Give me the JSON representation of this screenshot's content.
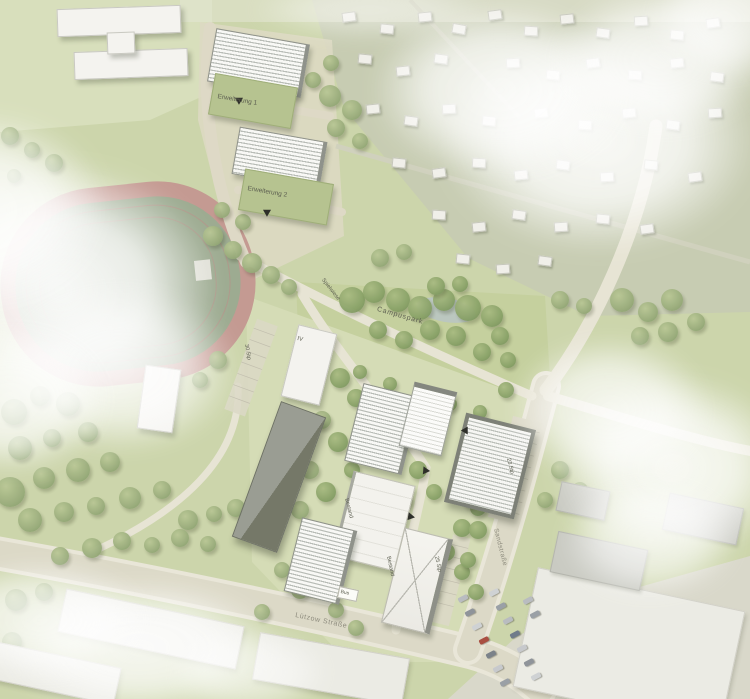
{
  "labels": {
    "erweiterung_1": "Erweiterung 1",
    "erweiterung_2": "Erweiterung 2",
    "campuspark": "Campuspark",
    "spielwiese": "Spielwiese",
    "street_bottom": "Lützow Straße",
    "street_right": "Sandstraße",
    "bus_stop": "Bus",
    "bestand_a": "Bestand",
    "bestand_b": "Bestand",
    "storeys_iv": "IV",
    "parking_a": "23 Stp",
    "parking_b": "25 Stp",
    "parking_c": "30 Stp"
  },
  "colors": {
    "base_green": "#ccd5ab",
    "lawn": "#d8dfbc",
    "allotment": "#c7ccb2",
    "park": "#c5d09e",
    "campus_ground": "#d5dcb6",
    "road": "#dcd9c7",
    "track_ring": "#c49a92",
    "track_infield": "#9dab91",
    "building_white": "#f4f3ef",
    "building_green": "#b6c390",
    "pond": "#b9c6c4",
    "industrial": "#d9d8ca"
  },
  "map_data": {
    "trees": [
      [
        14,
        412,
        13,
        0
      ],
      [
        40,
        396,
        10,
        0
      ],
      [
        68,
        404,
        12,
        0
      ],
      [
        20,
        448,
        12,
        0
      ],
      [
        52,
        438,
        9,
        0
      ],
      [
        88,
        432,
        10,
        0
      ],
      [
        10,
        492,
        15,
        0
      ],
      [
        44,
        478,
        11,
        0
      ],
      [
        78,
        470,
        12,
        0
      ],
      [
        110,
        462,
        10,
        0
      ],
      [
        30,
        520,
        12,
        0
      ],
      [
        64,
        512,
        10,
        0
      ],
      [
        96,
        506,
        9,
        0
      ],
      [
        130,
        498,
        11,
        0
      ],
      [
        162,
        490,
        9,
        0
      ],
      [
        188,
        520,
        10,
        0
      ],
      [
        214,
        514,
        8,
        0
      ],
      [
        236,
        508,
        9,
        0
      ],
      [
        60,
        556,
        9,
        0
      ],
      [
        92,
        548,
        10,
        0
      ],
      [
        122,
        541,
        9,
        0
      ],
      [
        152,
        545,
        8,
        0
      ],
      [
        180,
        538,
        9,
        0
      ],
      [
        208,
        544,
        8,
        0
      ],
      [
        16,
        600,
        11,
        0
      ],
      [
        44,
        592,
        9,
        0
      ],
      [
        12,
        642,
        10,
        0
      ],
      [
        262,
        612,
        8,
        0
      ],
      [
        10,
        136,
        9,
        0
      ],
      [
        32,
        150,
        8,
        0
      ],
      [
        54,
        163,
        9,
        0
      ],
      [
        14,
        176,
        7,
        0
      ],
      [
        213,
        236,
        10,
        0
      ],
      [
        233,
        250,
        9,
        0
      ],
      [
        252,
        263,
        10,
        0
      ],
      [
        271,
        275,
        9,
        0
      ],
      [
        289,
        287,
        8,
        0
      ],
      [
        243,
        222,
        8,
        0
      ],
      [
        222,
        210,
        8,
        0
      ],
      [
        330,
        96,
        11,
        0
      ],
      [
        352,
        110,
        10,
        0
      ],
      [
        336,
        128,
        9,
        0
      ],
      [
        360,
        141,
        8,
        0
      ],
      [
        331,
        63,
        8,
        0
      ],
      [
        313,
        80,
        8,
        0
      ],
      [
        352,
        300,
        13,
        1
      ],
      [
        374,
        292,
        11,
        1
      ],
      [
        398,
        300,
        12,
        1
      ],
      [
        420,
        308,
        12,
        1
      ],
      [
        444,
        300,
        11,
        1
      ],
      [
        468,
        308,
        13,
        1
      ],
      [
        492,
        316,
        11,
        1
      ],
      [
        430,
        330,
        10,
        1
      ],
      [
        456,
        336,
        10,
        1
      ],
      [
        404,
        340,
        9,
        1
      ],
      [
        378,
        330,
        9,
        1
      ],
      [
        500,
        336,
        9,
        1
      ],
      [
        482,
        352,
        9,
        1
      ],
      [
        508,
        360,
        8,
        1
      ],
      [
        436,
        286,
        9,
        1
      ],
      [
        460,
        284,
        8,
        1
      ],
      [
        360,
        372,
        7,
        1
      ],
      [
        390,
        384,
        7,
        1
      ],
      [
        420,
        396,
        7,
        1
      ],
      [
        450,
        404,
        7,
        1
      ],
      [
        480,
        412,
        7,
        1
      ],
      [
        506,
        390,
        8,
        1
      ],
      [
        340,
        378,
        10,
        1
      ],
      [
        356,
        398,
        9,
        1
      ],
      [
        322,
        420,
        9,
        0
      ],
      [
        338,
        442,
        10,
        1
      ],
      [
        310,
        470,
        9,
        0
      ],
      [
        326,
        492,
        10,
        1
      ],
      [
        300,
        510,
        9,
        0
      ],
      [
        352,
        470,
        8,
        1
      ],
      [
        368,
        448,
        8,
        1
      ],
      [
        418,
        470,
        9,
        1
      ],
      [
        434,
        492,
        8,
        1
      ],
      [
        404,
        500,
        8,
        1
      ],
      [
        462,
        528,
        9,
        1
      ],
      [
        478,
        508,
        8,
        1
      ],
      [
        446,
        552,
        9,
        1
      ],
      [
        462,
        572,
        8,
        1
      ],
      [
        430,
        592,
        8,
        1
      ],
      [
        300,
        590,
        9,
        0
      ],
      [
        282,
        570,
        8,
        0
      ],
      [
        336,
        610,
        8,
        0
      ],
      [
        356,
        628,
        8,
        0
      ],
      [
        622,
        300,
        12,
        0
      ],
      [
        648,
        312,
        10,
        0
      ],
      [
        672,
        300,
        11,
        0
      ],
      [
        640,
        336,
        9,
        0
      ],
      [
        668,
        332,
        10,
        0
      ],
      [
        696,
        322,
        9,
        0
      ],
      [
        560,
        300,
        9,
        0
      ],
      [
        584,
        306,
        8,
        0
      ],
      [
        380,
        258,
        9,
        0
      ],
      [
        404,
        252,
        8,
        0
      ],
      [
        472,
        440,
        9,
        1
      ],
      [
        480,
        470,
        8,
        1
      ],
      [
        470,
        500,
        8,
        1
      ],
      [
        478,
        530,
        9,
        1
      ],
      [
        468,
        560,
        8,
        1
      ],
      [
        476,
        592,
        8,
        1
      ],
      [
        560,
        470,
        9,
        0
      ],
      [
        580,
        490,
        8,
        0
      ],
      [
        545,
        500,
        8,
        0
      ],
      [
        218,
        360,
        9,
        0
      ],
      [
        200,
        380,
        8,
        0
      ]
    ],
    "buildings": [
      [
        118,
        20,
        122,
        26,
        -2,
        "white"
      ],
      [
        130,
        63,
        112,
        26,
        -2,
        "white"
      ],
      [
        120,
        42,
        26,
        20,
        -2,
        "white"
      ],
      [
        256,
        62,
        90,
        52,
        10,
        "hatched"
      ],
      [
        252,
        100,
        82,
        40,
        10,
        "green"
      ],
      [
        277,
        157,
        84,
        46,
        10,
        "hatched"
      ],
      [
        285,
        196,
        88,
        40,
        10,
        "green"
      ],
      [
        308,
        364,
        38,
        72,
        14,
        "white"
      ],
      [
        278,
        476,
        46,
        142,
        20,
        "dark"
      ],
      [
        380,
        428,
        54,
        78,
        14,
        "hatched"
      ],
      [
        427,
        416,
        42,
        60,
        14,
        "hatchedw"
      ],
      [
        486,
        462,
        64,
        84,
        14,
        "hatchedd"
      ],
      [
        372,
        520,
        60,
        86,
        14,
        "whiteroof"
      ],
      [
        318,
        560,
        52,
        74,
        14,
        "hatched"
      ],
      [
        414,
        580,
        44,
        96,
        14,
        "hipped"
      ],
      [
        158,
        398,
        34,
        62,
        8,
        "white"
      ],
      [
        150,
        628,
        180,
        42,
        12,
        "whiteflat"
      ],
      [
        52,
        672,
        130,
        36,
        12,
        "whiteflat"
      ],
      [
        330,
        668,
        150,
        46,
        10,
        "whiteflat"
      ],
      [
        628,
        648,
        210,
        120,
        12,
        "whiteflat"
      ],
      [
        598,
        560,
        90,
        40,
        12,
        "grayflat"
      ],
      [
        702,
        518,
        74,
        36,
        12,
        "grayflat"
      ],
      [
        582,
        500,
        48,
        28,
        12,
        "grayflat"
      ]
    ],
    "sheds": [
      [
        348,
        16,
        -8
      ],
      [
        386,
        28,
        6
      ],
      [
        424,
        16,
        -6
      ],
      [
        458,
        28,
        10
      ],
      [
        494,
        14,
        -8
      ],
      [
        530,
        30,
        4
      ],
      [
        566,
        18,
        -6
      ],
      [
        602,
        32,
        8
      ],
      [
        640,
        20,
        -4
      ],
      [
        676,
        34,
        6
      ],
      [
        712,
        22,
        -8
      ],
      [
        364,
        58,
        6
      ],
      [
        402,
        70,
        -6
      ],
      [
        440,
        58,
        8
      ],
      [
        512,
        62,
        -4
      ],
      [
        552,
        74,
        6
      ],
      [
        592,
        62,
        -8
      ],
      [
        634,
        74,
        4
      ],
      [
        676,
        62,
        -6
      ],
      [
        716,
        76,
        8
      ],
      [
        372,
        108,
        -6
      ],
      [
        410,
        120,
        8
      ],
      [
        448,
        108,
        -4
      ],
      [
        488,
        120,
        6
      ],
      [
        540,
        112,
        -8
      ],
      [
        584,
        124,
        4
      ],
      [
        628,
        112,
        -6
      ],
      [
        672,
        124,
        8
      ],
      [
        714,
        112,
        -4
      ],
      [
        398,
        162,
        6
      ],
      [
        438,
        172,
        -8
      ],
      [
        478,
        162,
        4
      ],
      [
        520,
        174,
        -6
      ],
      [
        562,
        164,
        8
      ],
      [
        606,
        176,
        -4
      ],
      [
        650,
        164,
        6
      ],
      [
        694,
        176,
        -8
      ],
      [
        438,
        214,
        4
      ],
      [
        478,
        226,
        -6
      ],
      [
        518,
        214,
        8
      ],
      [
        560,
        226,
        -4
      ],
      [
        602,
        218,
        6
      ],
      [
        646,
        228,
        -8
      ],
      [
        462,
        258,
        6
      ],
      [
        502,
        268,
        -4
      ],
      [
        544,
        260,
        8
      ]
    ],
    "cars": [
      [
        463,
        598,
        -28,
        "#b9bcc0"
      ],
      [
        470,
        612,
        -28,
        "#8f949a"
      ],
      [
        477,
        626,
        -28,
        "#cfd2d4"
      ],
      [
        484,
        640,
        -28,
        "#a94f42"
      ],
      [
        491,
        654,
        -28,
        "#7b8289"
      ],
      [
        498,
        668,
        -28,
        "#c7c9cc"
      ],
      [
        505,
        682,
        -28,
        "#9aa0a6"
      ],
      [
        494,
        592,
        -28,
        "#cfd2d4"
      ],
      [
        501,
        606,
        -28,
        "#9aa0a6"
      ],
      [
        508,
        620,
        -28,
        "#b9bcc0"
      ],
      [
        515,
        634,
        -28,
        "#6f7b8a"
      ],
      [
        522,
        648,
        -28,
        "#c7c9cc"
      ],
      [
        529,
        662,
        -28,
        "#8f949a"
      ],
      [
        536,
        676,
        -28,
        "#cfd2d4"
      ],
      [
        528,
        600,
        -28,
        "#b9bcc0"
      ],
      [
        535,
        614,
        -28,
        "#9aa0a6"
      ]
    ],
    "arrows": [
      [
        240,
        100,
        -120
      ],
      [
        268,
        212,
        -120
      ],
      [
        425,
        470,
        155
      ],
      [
        410,
        516,
        160
      ],
      [
        466,
        432,
        -30
      ]
    ],
    "clouds": [
      [
        598,
        140,
        320,
        230,
        0.92
      ],
      [
        500,
        90,
        260,
        180,
        0.85
      ],
      [
        660,
        60,
        220,
        150,
        0.8
      ],
      [
        60,
        290,
        320,
        260,
        0.97
      ],
      [
        -20,
        210,
        260,
        200,
        0.9
      ],
      [
        120,
        370,
        240,
        170,
        0.8
      ],
      [
        10,
        400,
        200,
        150,
        0.85
      ],
      [
        672,
        468,
        240,
        190,
        0.9
      ],
      [
        610,
        410,
        200,
        150,
        0.8
      ],
      [
        650,
        540,
        180,
        120,
        0.7
      ],
      [
        140,
        648,
        280,
        140,
        0.85
      ],
      [
        40,
        620,
        220,
        120,
        0.8
      ],
      [
        250,
        672,
        160,
        90,
        0.6
      ],
      [
        725,
        20,
        150,
        120,
        0.75
      ],
      [
        370,
        10,
        240,
        60,
        0.45
      ]
    ]
  }
}
